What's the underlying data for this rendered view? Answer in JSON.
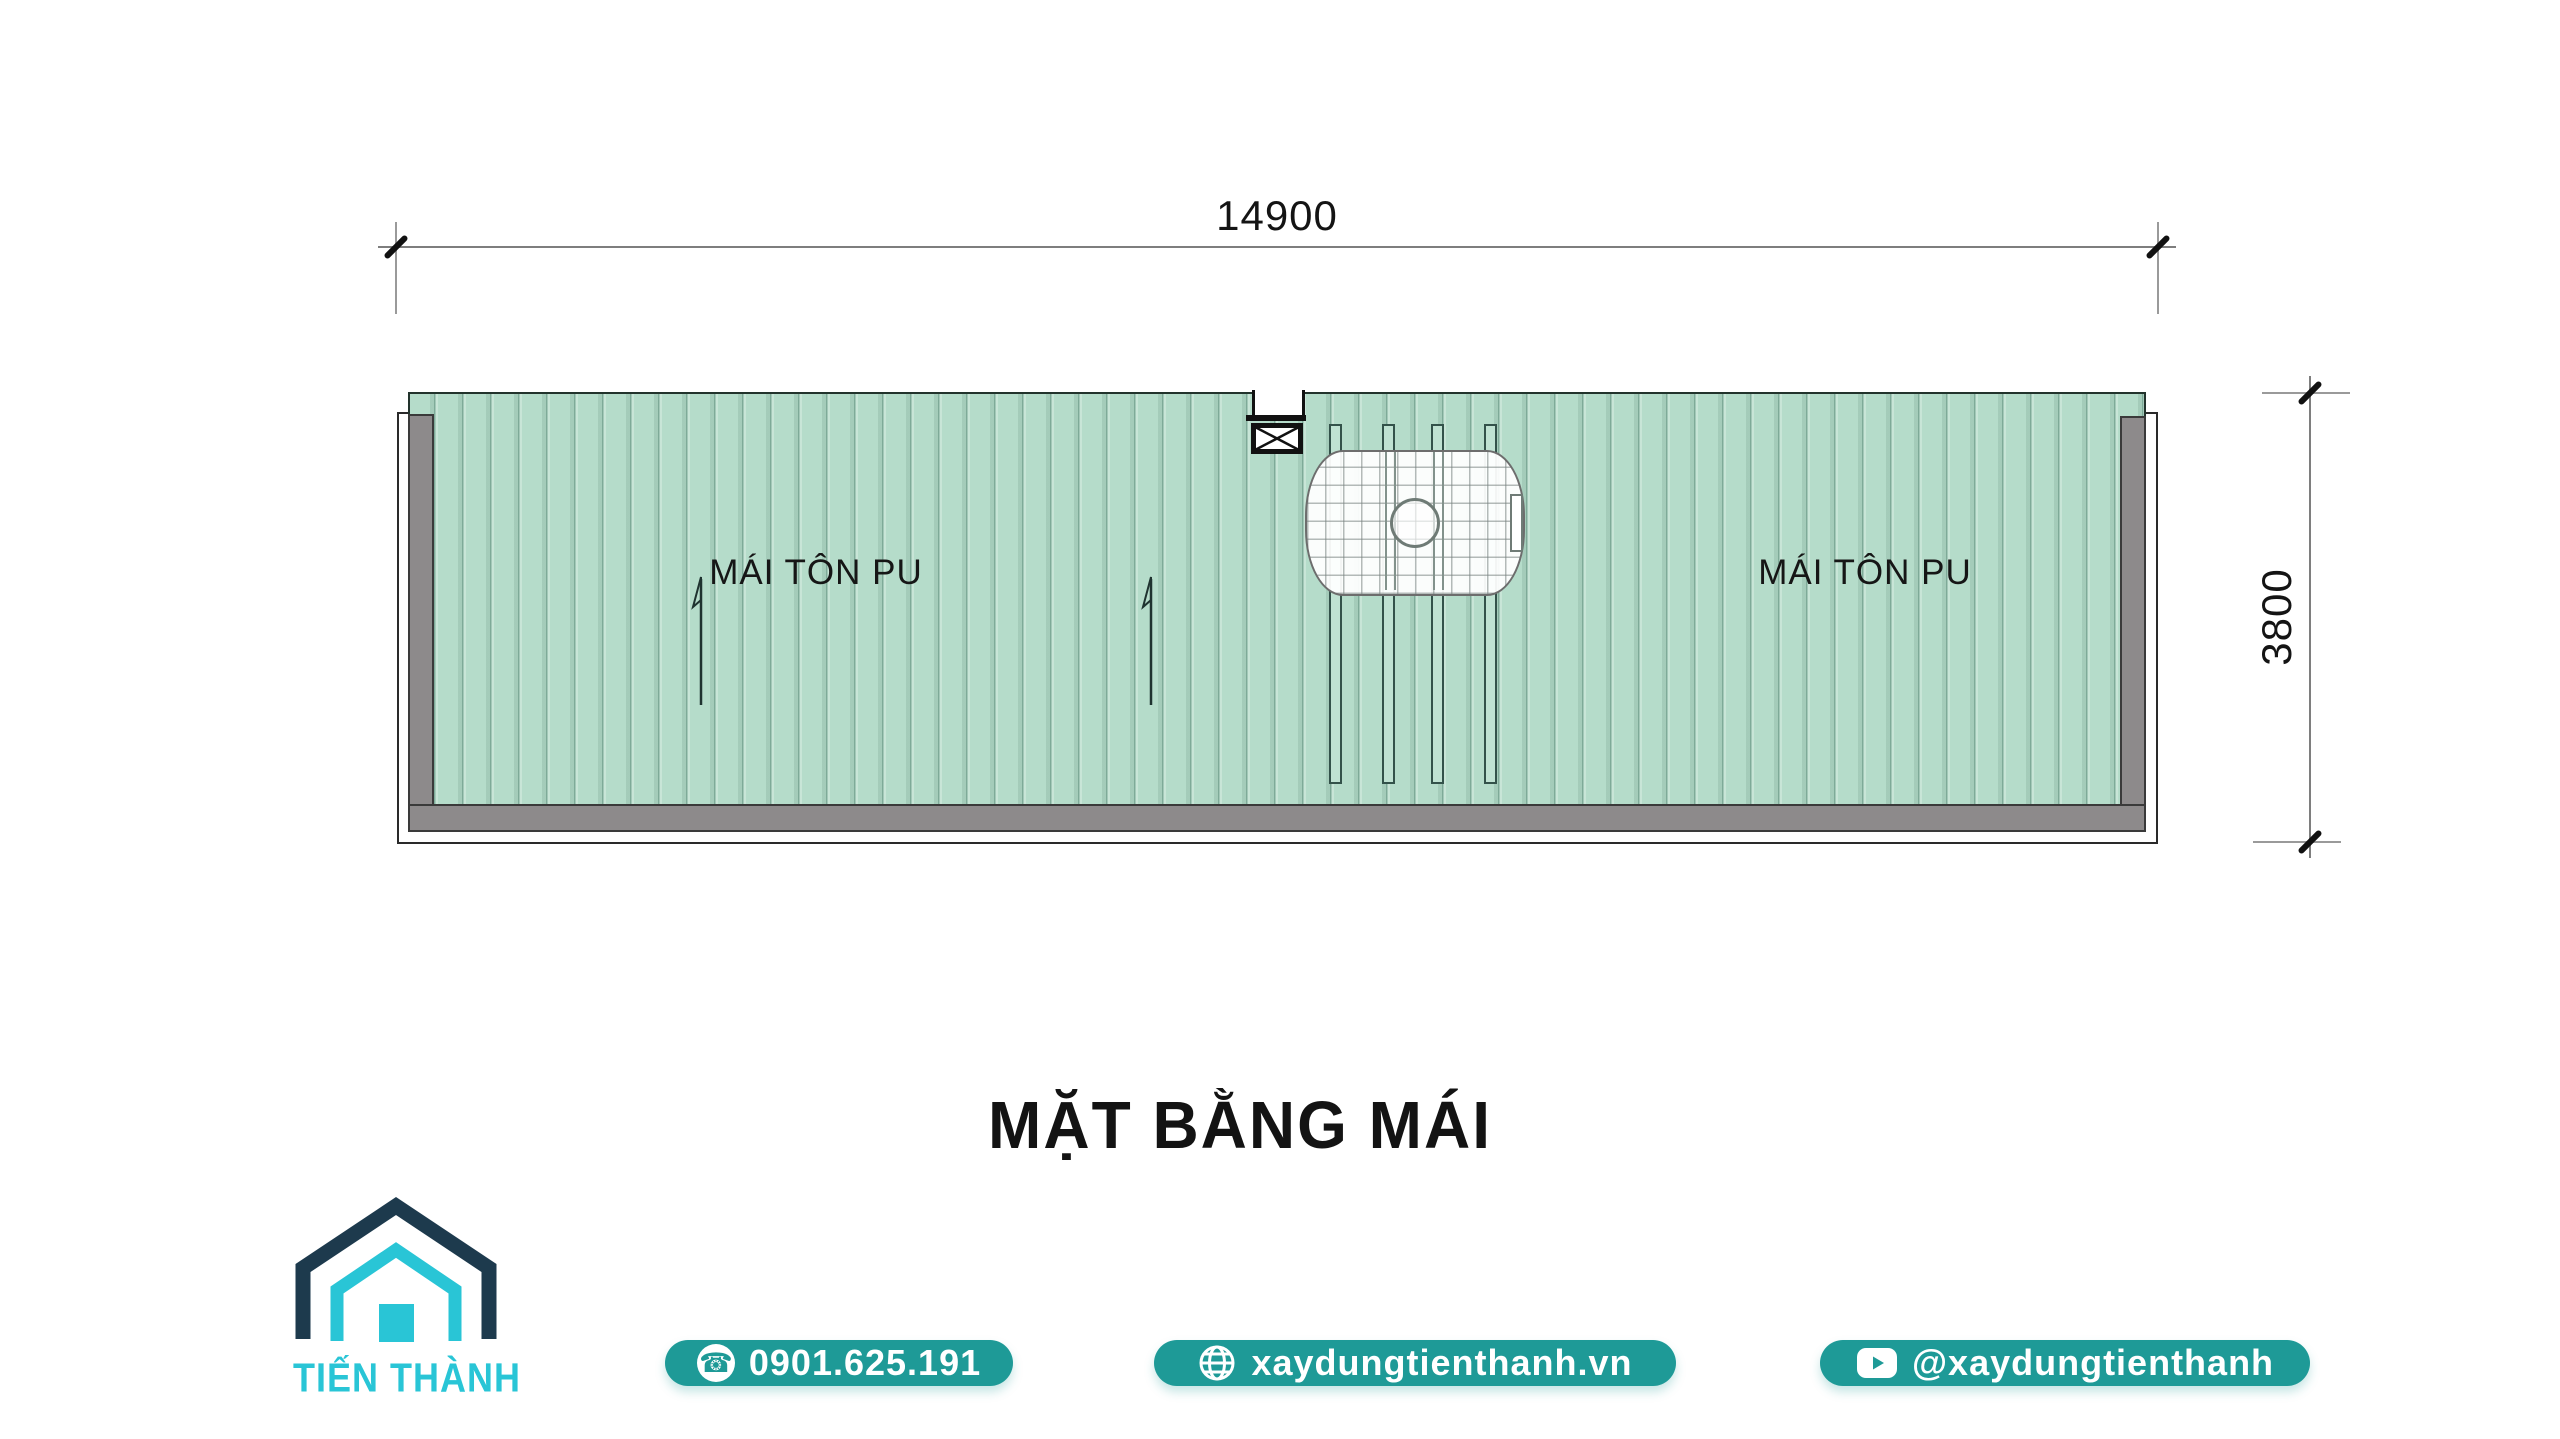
{
  "drawing": {
    "title": "MẶT BẰNG MÁI",
    "dimensions": {
      "width_label": "14900",
      "height_label": "3800"
    },
    "roof_left_label": "MÁI TÔN PU",
    "roof_right_label": "MÁI TÔN PU"
  },
  "branding": {
    "company": "TIẾN THÀNH"
  },
  "contacts": {
    "phone": "0901.625.191",
    "website": "xaydungtienthanh.vn",
    "social": "@xaydungtienthanh"
  },
  "icons": {
    "phone": "phone-icon",
    "globe": "globe-icon",
    "youtube": "youtube-icon",
    "house": "house-logo-icon",
    "hatch": "roof-hatch-icon"
  },
  "colors": {
    "roof_green": "#b5dcca",
    "wall_gray": "#8d8a8b",
    "button_teal": "#1e9a97",
    "logo_navy": "#1d3a4d",
    "logo_cyan": "#29c5d6"
  }
}
